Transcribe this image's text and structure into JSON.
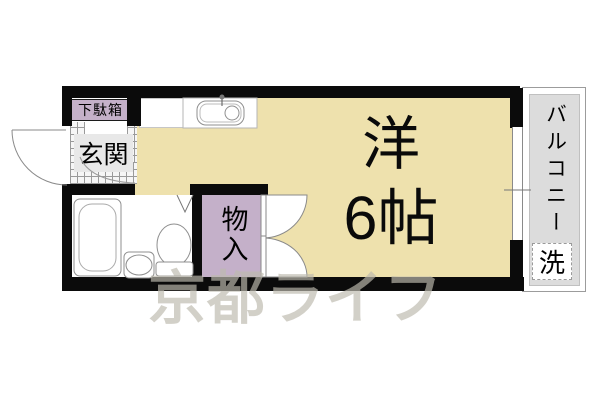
{
  "plan": {
    "watermark": "京都ライフ",
    "rooms": {
      "main_room": {
        "name_line1": "洋",
        "name_line2": "6帖"
      },
      "entrance": {
        "label": "玄関"
      },
      "shoe_cabinet": {
        "label": "下駄箱"
      },
      "storage": {
        "label": "物入"
      },
      "balcony": {
        "label": "バルコニー"
      },
      "laundry": {
        "label": "洗"
      }
    },
    "fixtures": [
      "bathtub",
      "toilet",
      "vanity-sink",
      "kitchen-sink",
      "entry-door-swing",
      "storage-folding-doors",
      "sliding-window"
    ],
    "colors": {
      "room_fill": "#eee1ad",
      "closet_fill": "#c4b0c9",
      "balcony_fill": "#dcdcdc",
      "wall": "#0b0b0b",
      "watermark": "rgba(188,186,174,0.68)"
    }
  }
}
